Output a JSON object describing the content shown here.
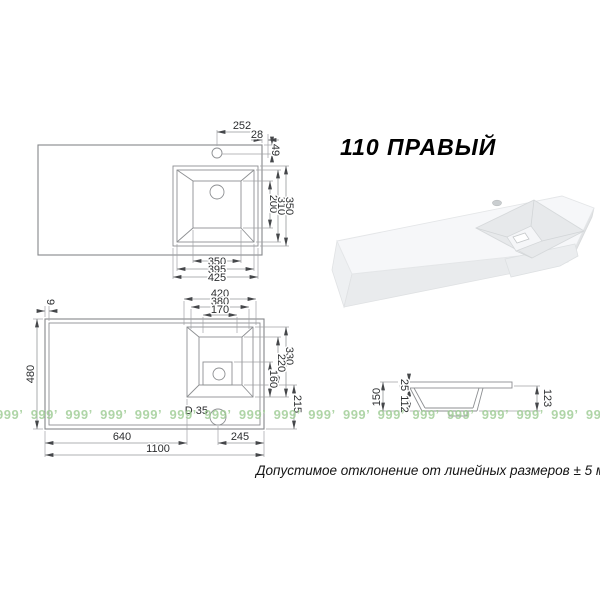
{
  "header": {
    "title": "110 ПРАВЫЙ"
  },
  "footer": {
    "tolerance_note": "Допустимое отклонение от линейных размеров ± 5 мм"
  },
  "watermark": {
    "unit": "999’",
    "repeat": 22,
    "color": "#9ccb92"
  },
  "top_view": {
    "dims": {
      "hole_to_edge": "252",
      "edge_offset": "28",
      "hole_from_front": "49",
      "bowl_depth_len": "200",
      "rim_inner_len": "310",
      "rim_outer_len": "350",
      "bowl_width": "350",
      "rim_inner_width": "395",
      "rim_outer_width": "425"
    }
  },
  "bottom_view": {
    "dims": {
      "rim_outer_width": "420",
      "rim_inner_width": "380",
      "drain_width": "170",
      "edge_border": "9",
      "depth": "480",
      "rim_outer_len": "330",
      "rim_inner_len": "220",
      "drain_len": "160",
      "hole_to_back": "215",
      "drain_diameter": "D 35",
      "left_section": "640",
      "hole_to_right": "245",
      "total_width": "1100"
    }
  },
  "section_view": {
    "dims": {
      "total_height": "150",
      "deck_thickness": "25",
      "bowl_depth": "112",
      "right_height": "123"
    }
  }
}
